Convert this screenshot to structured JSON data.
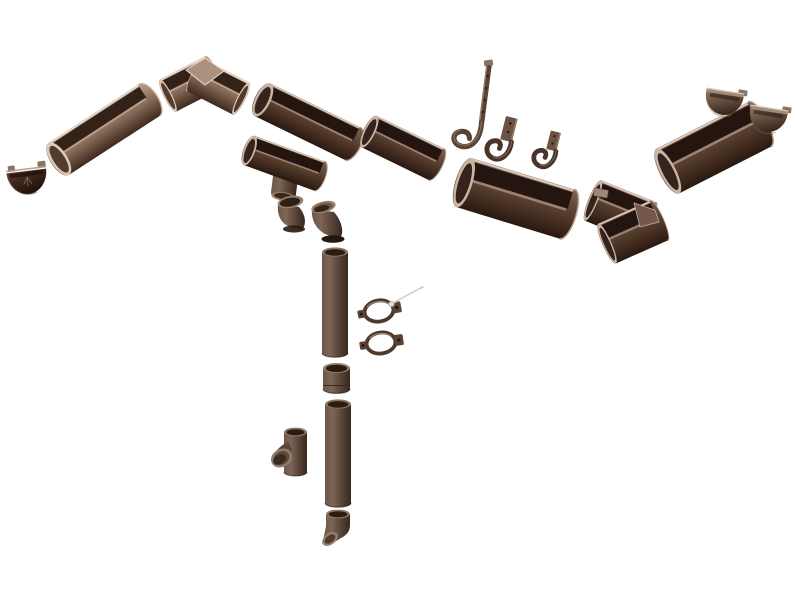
{
  "image": {
    "kind": "product-photo",
    "subject": "half-round rain gutter and downpipe system kit, chocolate brown, exploded layout on white"
  },
  "palette": {
    "background": "#ffffff",
    "chocolate_top": "#7d6151",
    "chocolate_mid": "#5a4030",
    "chocolate_dark": "#2a1910",
    "rosy_top": "#b89f8d",
    "rosy_mid": "#8a6e5b",
    "rosy_dark": "#3e2a1e",
    "pipe_base": "#6e5749",
    "pipe_light": "#7d6556",
    "pipe_shade": "#5b473a",
    "pipe_dark": "#38281e",
    "cap_light": "#8d7362",
    "cap_dark": "#321f14",
    "cap_left_light": "#55392a",
    "cap_left_dark": "#1d1008",
    "rim_highlight": "#dcccbe",
    "interior_shadow": "#241510",
    "metal_screw": "#c6cacd"
  },
  "parts": {
    "end_cap_left": {
      "label": "gutter end cap (left, with embossed logo)",
      "transform": "translate(27,177) rotate(-7)"
    },
    "gutter_left": {
      "label": "half-round gutter section (left run)",
      "transform": "translate(57,160) rotate(-33) scale(1.1,1)"
    },
    "corner_left": {
      "label": "90-degree gutter corner (inside view)",
      "transform": "translate(0,0)"
    },
    "gutter_mid_left": {
      "label": "half-round gutter section",
      "transform": "translate(261,99) rotate(26) scale(1.02,0.95)"
    },
    "gutter_outlet": {
      "label": "gutter outlet / funnel drop",
      "transform": "translate(0,0)"
    },
    "elbow_left": {
      "label": "downpipe elbow 45-degree",
      "transform": "translate(277,195)"
    },
    "elbow_right": {
      "label": "downpipe elbow 45-degree",
      "transform": "translate(311,200)"
    },
    "gutter_mid_right": {
      "label": "half-round gutter section",
      "transform": "translate(368,131) rotate(26) scale(0.76,0.92)"
    },
    "hook_long": {
      "label": "long strap rafter hook",
      "transform": "translate(0,0)"
    },
    "hook_medium": {
      "label": "fascia gutter bracket",
      "transform": "translate(506,116) rotate(14)"
    },
    "hook_short": {
      "label": "fascia gutter bracket (short)",
      "transform": "translate(549,130) rotate(14) scale(0.95)"
    },
    "gutter_right": {
      "label": "half-round gutter section (right run)",
      "transform": "translate(462,182) rotate(17) scale(1.1,1.35)"
    },
    "corner_right": {
      "label": "90-degree gutter corner (outside view)",
      "transform": "translate(0,0)"
    },
    "gutter_far_right": {
      "label": "half-round gutter section (far right)",
      "transform": "translate(666,172) rotate(-27) scale(1.05,1.32)"
    },
    "end_cap_right_a": {
      "label": "gutter end cap",
      "transform": "translate(724,100) rotate(9)"
    },
    "end_cap_right_b": {
      "label": "gutter end cap",
      "transform": "translate(768,117) rotate(9)"
    },
    "pipe_upper": {
      "label": "downpipe (upper length)",
      "transform": "translate(322,252)"
    },
    "clamp_upper": {
      "label": "downpipe clamp ring",
      "transform": "translate(379,311) rotate(-10)"
    },
    "clamp_screw": {
      "label": "clamp fixing screw",
      "transform": "translate(0,0)"
    },
    "clamp_lower": {
      "label": "downpipe clamp ring",
      "transform": "translate(381,343) rotate(-8)"
    },
    "pipe_coupler": {
      "label": "downpipe coupler socket",
      "transform": "translate(323,366)"
    },
    "pipe_lower": {
      "label": "downpipe (lower length)",
      "transform": "translate(325,404)"
    },
    "pipe_tee": {
      "label": "downpipe tee branch",
      "transform": "translate(284,430)"
    },
    "pipe_shoe": {
      "label": "downpipe shoe outlet",
      "transform": "translate(326,512)"
    }
  }
}
